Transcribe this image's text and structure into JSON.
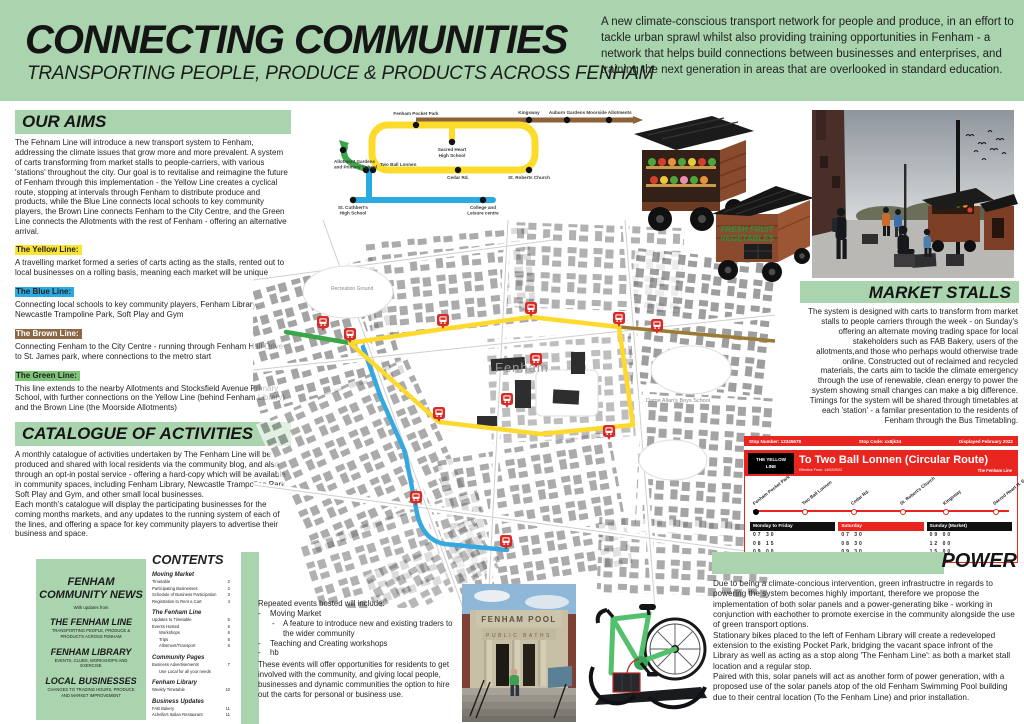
{
  "colors": {
    "header_green": "#a9d4ae",
    "highlight_yellow": "#f9e431",
    "highlight_blue": "#29abe2",
    "highlight_brown": "#8c6844",
    "highlight_green": "#7cc576",
    "route_yellow": "#ffd92b",
    "route_blue": "#35a8e0",
    "route_brown": "#9b7b33",
    "route_green": "#3aa648",
    "timetable_red": "#e8251f"
  },
  "header": {
    "title": "CONNECTING COMMUNITIES",
    "subtitle": "TRANSPORTING PEOPLE, PRODUCE & PRODUCTS ACROSS FENHAM",
    "intro": "A new climate-conscious transport network for people and produce, in an effort to tackle urban sprawl whilst also providing training opportunities in Fenham - a network that helps build connections between businesses and enterprises, and training the next generation in areas that are overlooked in standard education."
  },
  "our_aims": {
    "heading": "OUR AIMS",
    "body": "The Fehnam Line will introduce a new transport system to Fenham, addressing the climate issues that grow more and more prevalent. A system of carts transforming from market stalls to people-carriers, with various 'stations' throughout the city. Our goal is to revitalise and reimagine the future of Fenham through this implementation - the Yellow Line creates a cyclical route, stopping at intervals through Fenham to distribute produce and products, while the Blue Line connects local schools to key community players, the Brown Line connects Fenham to the City Centre, and the Green Line connects the Allotments with the rest of Fenham - offering an alternative arrival.",
    "lines": [
      {
        "label": "The Yellow Line:",
        "color": "#f9e431",
        "text": "A travelling market formed a series of carts acting as the stalls, rented out to local businesses on a rolling basis, meaning each market will be unique"
      },
      {
        "label": "The Blue Line:",
        "color": "#29abe2",
        "text": "Connecting local schools to key community players, Fenham Library, Newcastle Trampoline Park, Soft Play and Gym"
      },
      {
        "label": "The Brown Line:",
        "color": "#8c6844",
        "text": "Connecting Fenham to the City Centre - running through Fenham Hall Drive to St. James park, where connections to the metro start"
      },
      {
        "label": "The Green Line:",
        "color": "#7cc576",
        "text": "This line extends to the nearby Allotments and Stocksfield Avenue Primary School, with further connections on the Yellow Line (behind Fenham Library) and the Brown Line (the Moorside Allotments)"
      }
    ]
  },
  "catalogue": {
    "heading": "CATALOGUE OF ACTIVITIES",
    "body": "A monthly catalogue of activities undertaken by The Fenham Line will be produced and shared with local residents via the community blog, and also through an opt-in postal service - offering a hard-copy which will be available in community spaces, including Fenham Library, Newcastle Trampoline Park, Soft Play and Gym, and other small local businesses.\nEach month's catalogue will display the participating businesses for the coming months markets, and any updates to the running system of each of the lines, and offering a space for key community players to advertise their business and space."
  },
  "community_news": {
    "title": "FENHAM COMMUNITY NEWS",
    "tagline": "With updates from",
    "entries": [
      {
        "name": "THE FENHAM LINE",
        "desc": "TRANSPORTING PEOPLE, PRODUCE & PRODUCTS ACROSS FENHAM"
      },
      {
        "name": "FENHAM LIBRARY",
        "desc": "EVENTS, CLUBS, WORKSHOPS AND EXERCISE"
      },
      {
        "name": "LOCAL BUSINESSES",
        "desc": "CHANGES TO TRADING HOURS, PRODUCE AND MARKET IMPROVEMENT"
      }
    ]
  },
  "contents": {
    "heading": "CONTENTS",
    "sections": [
      {
        "title": "Moving Market",
        "items": [
          {
            "label": "Timetable",
            "page": "2"
          },
          {
            "label": "Participating Businesses",
            "page": "2"
          },
          {
            "label": "Schedule of Business Participation",
            "page": "3"
          },
          {
            "label": "Registration to Rent a Cart",
            "page": "4"
          }
        ]
      },
      {
        "title": "The Fenham Line",
        "items": [
          {
            "label": "Updates to Timetable",
            "page": "5"
          },
          {
            "label": "Events Hosted",
            "page": "6"
          },
          {
            "label": "Workshops",
            "page": "6"
          },
          {
            "label": "Trips",
            "page": "6"
          },
          {
            "label": "Allotment/Transport",
            "page": "6"
          }
        ]
      },
      {
        "title": "Community Pages",
        "items": [
          {
            "label": "Business Advertisements",
            "page": "7"
          },
          {
            "label": "Use Local for all your needs",
            "page": ""
          }
        ]
      },
      {
        "title": "Fenham Library",
        "items": [
          {
            "label": "Weekly Timetable",
            "page": "10"
          }
        ]
      },
      {
        "title": "Business Updates",
        "items": [
          {
            "label": "FAB Bakery",
            "page": "11"
          },
          {
            "label": "Achella's Italian Restaurant",
            "page": "11"
          }
        ]
      }
    ]
  },
  "transit": {
    "stations": {
      "fenham_pocket_park": "Fenham Pocket Park",
      "kingsway": "Kingsway",
      "auburn_gardens": "Auburn Gardens",
      "moorside_allotments": "Moorside Allotments",
      "sacred_heart_l1": "Sacred Heart",
      "sacred_heart_l2": "High School",
      "two_ball_lonnen": "Two Ball Lonnen",
      "cedar_rd": "Cedar Rd.",
      "st_roberts": "St. Roberts Church",
      "allotment_l1": "Allotment Gardens",
      "allotment_l2": "and Primary School",
      "st_cuthberts_l1": "St. Cuthbert's",
      "st_cuthberts_l2": "High School",
      "college_l1": "College and",
      "college_l2": "Leisure centre"
    }
  },
  "map": {
    "area_label": "Fenham",
    "school_label": "Dame Allan's Boys School",
    "park_label": "Recreation Ground"
  },
  "carts": {
    "sign_line1": "FRESH FRUIT",
    "sign_line2": "VEGETABLES"
  },
  "market_stalls": {
    "heading": "MARKET STALLS",
    "body": "The system is designed with carts to transform from market stalls to people carriers through the week - on Sunday's offering an alternate moving trading space for local stakeholders such as FAB Bakery, users of the allotments,and those who perhaps would otherwise trade online. Constructed out of reclaimed and recycled materials, the carts aim to tackle the climate emergency through the use of renewable, clean energy to power the system showing small changes can make a big difference. Timings for the system will be shared through timetables at each 'station' - a familar presentation to the residents of Fenham through the Bus Timetabling."
  },
  "timetable": {
    "stop_number": "Stop Number: 12345678",
    "stop_code": "Stop Code: xx8jk34",
    "displayed": "Displayed February 2022",
    "badge": "THE YELLOW\nLINE",
    "title": "To Two Ball Lonnen (Circular Route)",
    "effective": "Effective From: 14/02/2022",
    "brand": "The Fenham Line",
    "stops": [
      "Fenham Pocket Park",
      "Two Ball Lonnen",
      "Cedar Rd.",
      "St. Robert's Church",
      "Kingsway",
      "Sacred Heart H. School"
    ],
    "columns": [
      {
        "label": "Monday to Friday",
        "times": [
          "07 30",
          "08 15",
          "09 00"
        ]
      },
      {
        "label": "Saturday",
        "times": [
          "07 30",
          "08 30",
          "09 30"
        ]
      },
      {
        "label": "Sunday (Market)",
        "times": [
          "09 00",
          "12 00",
          "15 00"
        ]
      }
    ]
  },
  "power": {
    "heading": "POWER",
    "body": "Due to being a climate-concious intervention, green infrastructre in regards to powering the system becomes highly important, therefore we propose the implementation of both solar panels and a power-generating bike - working in conjunction with eachother to promote exercise in the community alongside the use of green transport options.\nStationary bikes placed to the left of Fenham Library will create a redeveloped extension to the existing Pocket Park, bridging the vacant space infront of the Library as well as acting as a stop along 'The Fenham Line': as both a market stall location and a regular stop.\nPaired with this, solar panels will act as another form of power generation, with a proposed use of the solar panels atop of the old Fenham Swimming Pool building due to their central location (To the Fenham Line) and prior installation."
  },
  "events": {
    "intro": "Repeated events hosted will include:",
    "items": [
      {
        "text": "Moving Market"
      },
      {
        "text": "A feature to introduce new and existing traders to the wider community"
      },
      {
        "text": "Teaching and Creating workshops"
      },
      {
        "text": "hb"
      }
    ],
    "outro": "These events will offer opportunities for residents to get involved with the community, and giving local people, businesses and dynamic communities the option to hire out the carts for personal or business use."
  },
  "pool_photo": {
    "line1": "FENHAM POOL",
    "line2": "PUBLIC BATHS"
  }
}
